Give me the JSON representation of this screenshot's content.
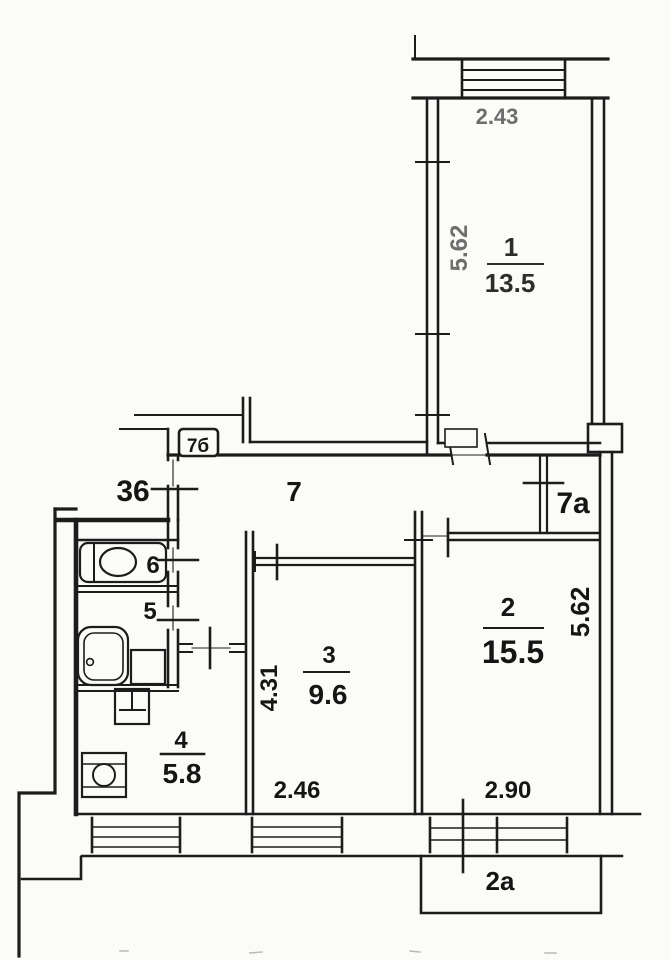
{
  "colors": {
    "ink": "#1c1c1c",
    "faded": "#6e6e6e",
    "paper": "#fbfbf8"
  },
  "rooms": {
    "r1": {
      "number": "1",
      "area": "13.5",
      "width_dim": "2.43",
      "depth_dim": "5.62"
    },
    "r2": {
      "number": "2",
      "area": "15.5",
      "width_dim": "2.90",
      "depth_dim": "5.62"
    },
    "r3": {
      "number": "3",
      "area": "9.6",
      "width_dim": "2.46",
      "depth_dim": "4.31"
    },
    "kitchen": {
      "number": "4",
      "area": "5.8"
    },
    "bath": {
      "number": "5"
    },
    "wc": {
      "number": "6"
    },
    "hall": {
      "number": "7"
    },
    "corridor": {
      "number": "7a"
    },
    "closet": {
      "number": "7б"
    },
    "balcony": {
      "number": "2a"
    },
    "landing": {
      "number": "36"
    }
  }
}
